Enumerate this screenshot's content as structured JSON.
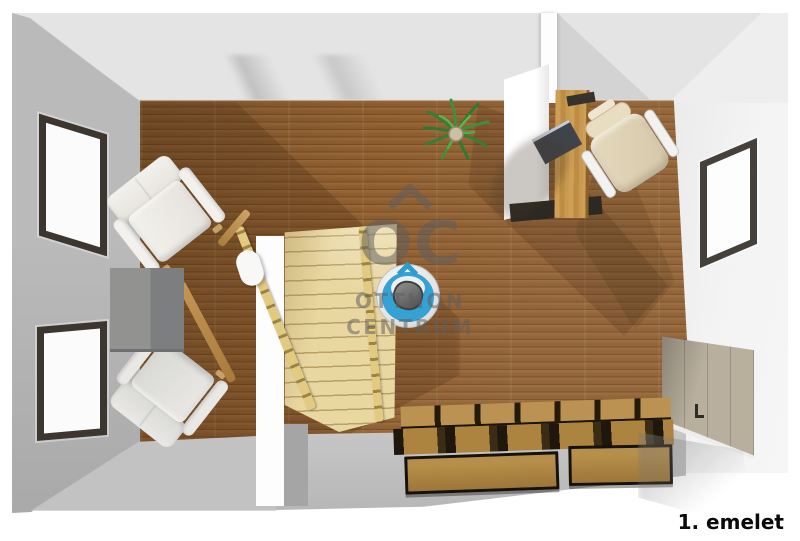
{
  "floor_label": "1. emelet",
  "watermark": {
    "logo_text": "OC",
    "line1": "OTTHON",
    "line2": "CENTRUM"
  },
  "palette": {
    "floor_wood": "#8d5d30",
    "stair_wood": "#e9d7a2",
    "wall_gray": "#b4b4b4",
    "wall_light": "#e4e4e4",
    "wall_white": "#fdfdfd",
    "window_frame": "#3c362e",
    "chair_blue": "#35a2d4",
    "wardrobe_beige": "#b8af9d",
    "bed_wood": "#ad843f",
    "label_text": "#0a0a0a",
    "watermark_gray": "#5f5f5f"
  },
  "objects": [
    "left-wall-window-top",
    "left-wall-window-bottom",
    "right-wall-window",
    "armchair-upper",
    "armchair-lower",
    "side-table",
    "staircase",
    "stair-railing-left",
    "stair-railing-right",
    "potted-plant",
    "office-chair-blue",
    "office-chair-beige",
    "desk",
    "laptop",
    "wardrobe",
    "storage-bed-drawers"
  ]
}
